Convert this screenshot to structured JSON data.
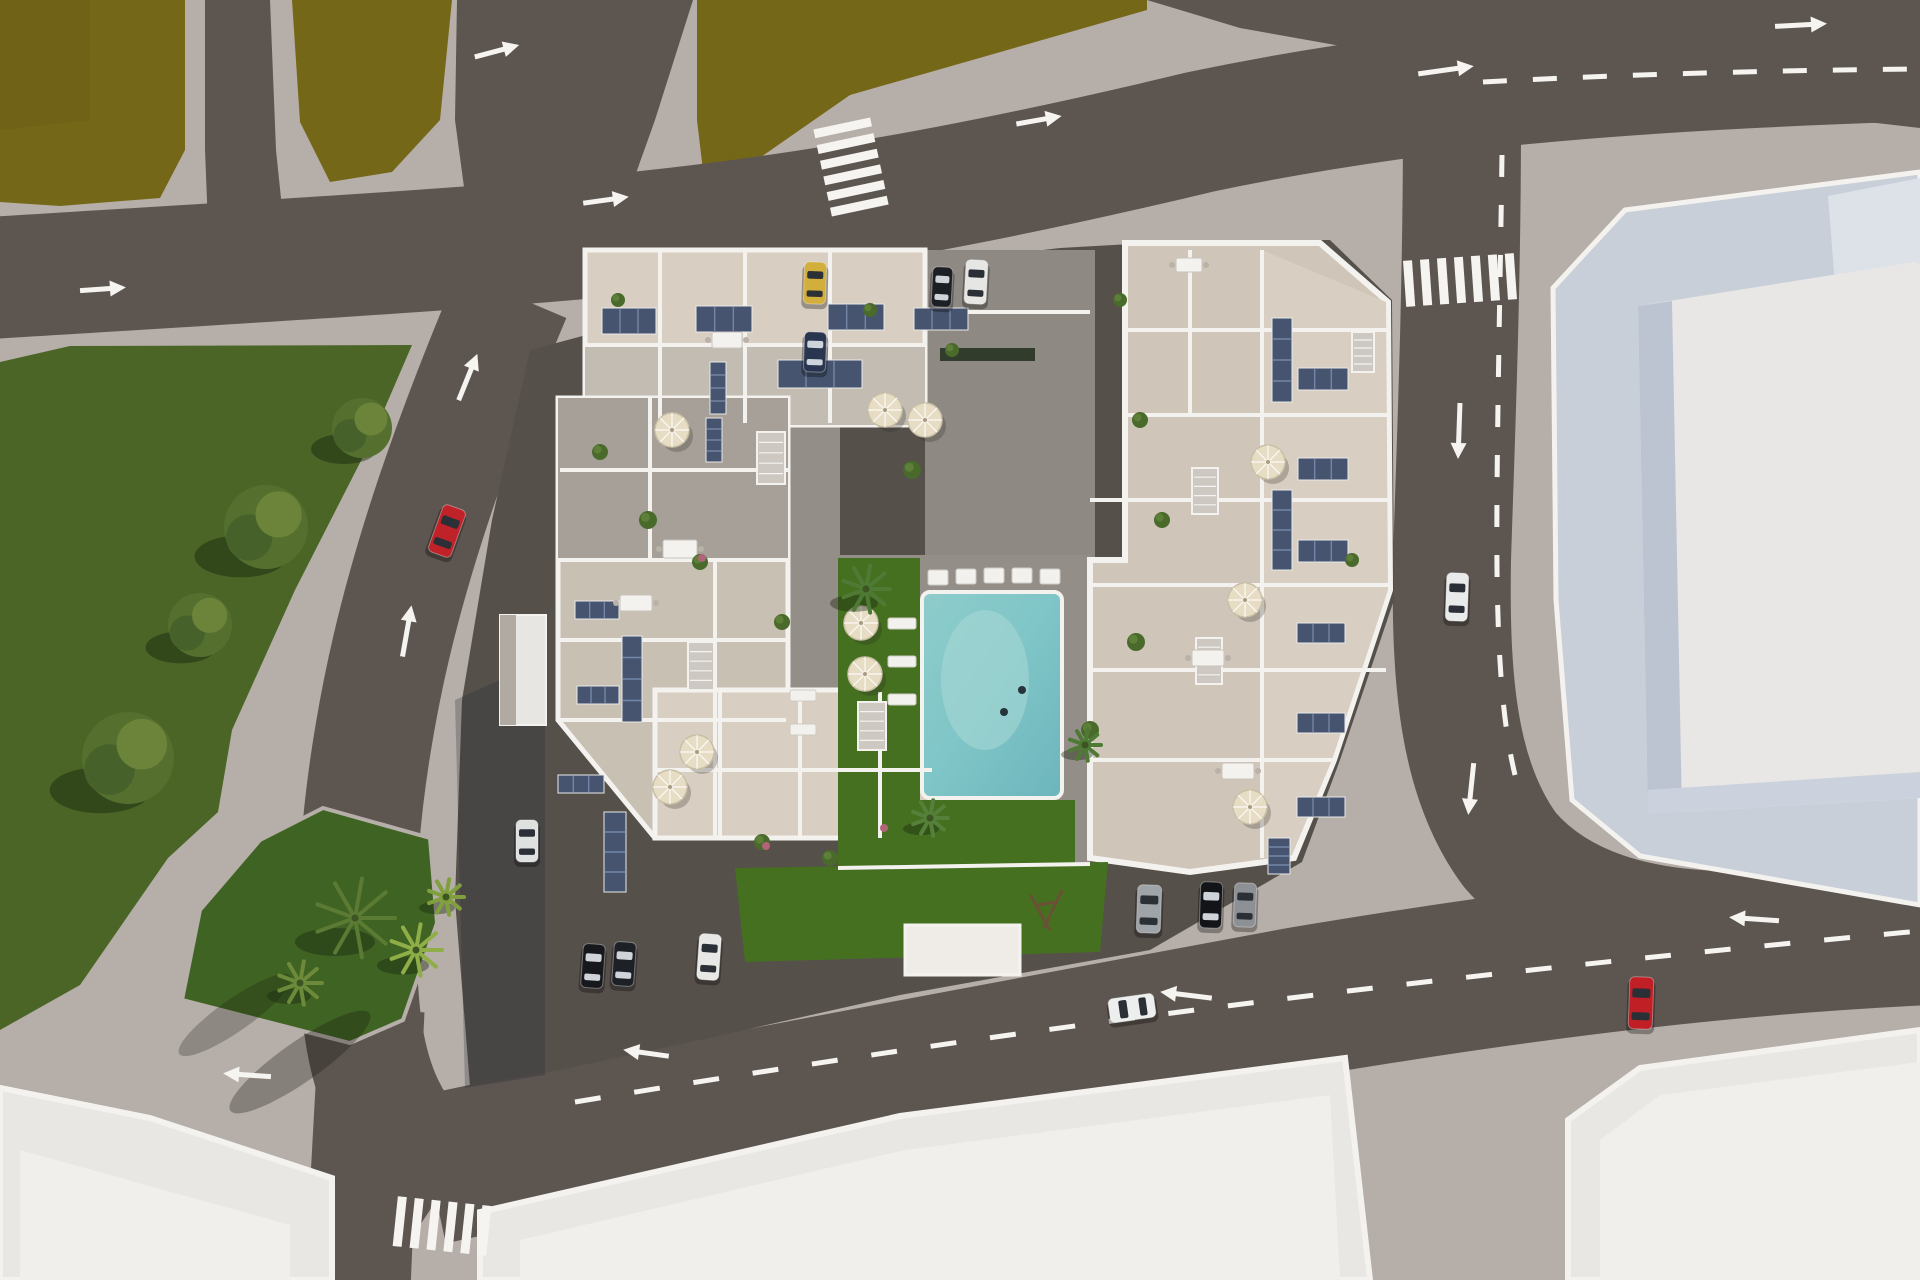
{
  "scene": {
    "description": "aerial-3d-render-residential-complex-with-pool",
    "view": "top-down-site-plan"
  },
  "palette": {
    "sidewalk": "#b6aea8",
    "sidewalkShade": "#9d958f",
    "road": "#5d5550",
    "roadDark": "#544d48",
    "apron": "#56504b",
    "field": "#756718",
    "fieldDark": "#665a14",
    "park": "#4a6526",
    "parkDark": "#36511c",
    "lawn": "#447020",
    "island": "#3f6322",
    "pool": "#7fc5c7",
    "poolLight": "#a9d9d6",
    "white": "#f4f2ef",
    "beige": "#d8cec1",
    "beigeShade": "#c3bcb2",
    "roofGray": "#a6a099",
    "roofGray2": "#c9c0b4",
    "eastWest": "#cfc5b8",
    "courtPave": "#948e88",
    "entryPave": "#8f8983",
    "panel": "#46546f",
    "panelLine": "#7487a8",
    "umbrella": "#e7ddc5",
    "stair": "#cdc8c1",
    "bigBuildTop": "#e9e7e6",
    "bigBuildSide": "#bdc4d1",
    "bigBuildPlinth": "#c9cfd9",
    "bigBuildWing": "#dde1e8",
    "bottomBuild": "#e9e7e4",
    "bottomBuildIn": "#f1efec",
    "marking": "#f5f4f1"
  },
  "cars": [
    {
      "name": "car-red-left-road",
      "x": 447,
      "y": 531,
      "w": 24,
      "h": 50,
      "rot": 20,
      "color": "#bf2228",
      "dark": false
    },
    {
      "name": "car-yellow-parked-top",
      "x": 815,
      "y": 283,
      "w": 22,
      "h": 42,
      "rot": 2,
      "color": "#d2ae3c",
      "dark": false
    },
    {
      "name": "car-darkblue-parked-top",
      "x": 815,
      "y": 352,
      "w": 22,
      "h": 40,
      "rot": 2,
      "color": "#2a3550",
      "dark": true
    },
    {
      "name": "car-black-parked-top",
      "x": 942,
      "y": 287,
      "w": 20,
      "h": 40,
      "rot": 3,
      "color": "#1c1f24",
      "dark": true
    },
    {
      "name": "car-white-parked-top",
      "x": 976,
      "y": 282,
      "w": 22,
      "h": 44,
      "rot": 3,
      "color": "#e6e6e4",
      "dark": false
    },
    {
      "name": "car-white-parked-west",
      "x": 527,
      "y": 841,
      "w": 22,
      "h": 42,
      "rot": 0,
      "color": "#dfe0e0",
      "dark": false
    },
    {
      "name": "car-dark-parked-south-1",
      "x": 593,
      "y": 966,
      "w": 22,
      "h": 44,
      "rot": 4,
      "color": "#16181c",
      "dark": true
    },
    {
      "name": "car-dark-parked-south-2",
      "x": 624,
      "y": 964,
      "w": 22,
      "h": 44,
      "rot": 4,
      "color": "#1d2026",
      "dark": true
    },
    {
      "name": "car-white-parked-south",
      "x": 709,
      "y": 957,
      "w": 22,
      "h": 46,
      "rot": 4,
      "color": "#e8e8e6",
      "dark": false
    },
    {
      "name": "car-silver-parked-southeast",
      "x": 1149,
      "y": 909,
      "w": 24,
      "h": 48,
      "rot": 2,
      "color": "#9fa4a8",
      "dark": false
    },
    {
      "name": "car-black-parked-southeast",
      "x": 1211,
      "y": 905,
      "w": 22,
      "h": 46,
      "rot": 2,
      "color": "#121418",
      "dark": true
    },
    {
      "name": "car-gray-parked-southeast",
      "x": 1245,
      "y": 905,
      "w": 22,
      "h": 44,
      "rot": 2,
      "color": "#8d9196",
      "dark": false
    },
    {
      "name": "car-white-driving-bottom-road",
      "x": 1132,
      "y": 1008,
      "w": 46,
      "h": 24,
      "rot": -8,
      "color": "#edeeee",
      "dark": false
    },
    {
      "name": "car-red-bottom-right",
      "x": 1641,
      "y": 1003,
      "w": 24,
      "h": 52,
      "rot": 2,
      "color": "#c01f26",
      "dark": false
    },
    {
      "name": "car-white-right-road",
      "x": 1457,
      "y": 597,
      "w": 22,
      "h": 48,
      "rot": 2,
      "color": "#e9eaea",
      "dark": false
    }
  ],
  "arrows": [
    {
      "name": "arrow-top-vertical-road",
      "x": 497,
      "y": 51,
      "rot": -15,
      "len": 46
    },
    {
      "name": "arrow-left-road",
      "x": 103,
      "y": 289,
      "rot": -4,
      "len": 46
    },
    {
      "name": "arrow-mid-top-road",
      "x": 606,
      "y": 200,
      "rot": -8,
      "len": 46
    },
    {
      "name": "arrow-diag-road-up-1",
      "x": 468,
      "y": 377,
      "rot": -68,
      "len": 50
    },
    {
      "name": "arrow-diag-road-up-2",
      "x": 407,
      "y": 631,
      "rot": -80,
      "len": 52
    },
    {
      "name": "arrow-top-road-east",
      "x": 1039,
      "y": 120,
      "rot": -10,
      "len": 46
    },
    {
      "name": "arrow-top-right",
      "x": 1801,
      "y": 25,
      "rot": -3,
      "len": 52
    },
    {
      "name": "arrow-merge-top-right",
      "x": 1446,
      "y": 70,
      "rot": -8,
      "len": 56
    },
    {
      "name": "arrow-right-road-down-1",
      "x": 1459,
      "y": 431,
      "rot": 92,
      "len": 56
    },
    {
      "name": "arrow-right-road-down-2",
      "x": 1471,
      "y": 789,
      "rot": 96,
      "len": 52
    },
    {
      "name": "arrow-bottom-road-left-1",
      "x": 1186,
      "y": 995,
      "rot": 187,
      "len": 52
    },
    {
      "name": "arrow-bottom-road-left-2",
      "x": 646,
      "y": 1053,
      "rot": 188,
      "len": 46
    },
    {
      "name": "arrow-bottom-road-left-3",
      "x": 247,
      "y": 1075,
      "rot": 184,
      "len": 48
    },
    {
      "name": "arrow-bottom-right-road",
      "x": 1754,
      "y": 919,
      "rot": 184,
      "len": 50
    }
  ],
  "crosswalks": [
    {
      "name": "crosswalk-top-middle",
      "x": 851,
      "y": 167,
      "rot": -12,
      "count": 6,
      "sw": 58,
      "sh": 9,
      "gap": 7,
      "dir": "h"
    },
    {
      "name": "crosswalk-right-road",
      "x": 1460,
      "y": 280,
      "rot": -4,
      "count": 7,
      "sw": 9,
      "sh": 46,
      "gap": 8,
      "dir": "v"
    },
    {
      "name": "crosswalk-bottom-left",
      "x": 442,
      "y": 1226,
      "rot": 6,
      "count": 6,
      "sw": 9,
      "sh": 50,
      "gap": 8,
      "dir": "v"
    }
  ],
  "dashes": [
    {
      "name": "lane-dash-bottom-road",
      "path": "M575,1102 C900,1048 1300,988 1920,931",
      "dash": "26 34"
    },
    {
      "name": "lane-dash-right-road",
      "path": "M1502,155 C1500,300 1496,470 1497,570 C1498,660 1503,725 1515,775",
      "dash": "22 28"
    },
    {
      "name": "lane-dash-top-right-road",
      "path": "M1483,82 C1630,74 1790,70 1920,69",
      "dash": "24 26"
    }
  ],
  "trees": [
    {
      "name": "park-tree-1",
      "x": 362,
      "y": 428,
      "r": 30
    },
    {
      "name": "park-tree-2",
      "x": 266,
      "y": 527,
      "r": 42
    },
    {
      "name": "park-tree-3",
      "x": 200,
      "y": 625,
      "r": 32
    },
    {
      "name": "park-tree-4",
      "x": 128,
      "y": 758,
      "r": 46
    }
  ],
  "palms": [
    {
      "name": "palm-island-large",
      "x": 355,
      "y": 918,
      "r": 40,
      "color": "#5b7a33"
    },
    {
      "name": "palm-island-bright",
      "x": 416,
      "y": 950,
      "r": 26,
      "color": "#8fae47"
    },
    {
      "name": "palm-island-small",
      "x": 300,
      "y": 983,
      "r": 22,
      "color": "#6d8a3a"
    },
    {
      "name": "palm-island-bush",
      "x": 446,
      "y": 897,
      "r": 18,
      "color": "#7fa03c"
    },
    {
      "name": "palm-courtyard",
      "x": 866,
      "y": 589,
      "r": 24,
      "color": "#4f7a35"
    },
    {
      "name": "palm-courtyard-south",
      "x": 930,
      "y": 818,
      "r": 18,
      "color": "#55803a"
    },
    {
      "name": "palm-pool-corner",
      "x": 1085,
      "y": 745,
      "r": 16,
      "color": "#4f7a35"
    }
  ],
  "plants": [
    {
      "x": 600,
      "y": 452,
      "r": 8
    },
    {
      "x": 648,
      "y": 520,
      "r": 9
    },
    {
      "x": 700,
      "y": 562,
      "r": 8
    },
    {
      "x": 782,
      "y": 622,
      "r": 8
    },
    {
      "x": 912,
      "y": 470,
      "r": 9
    },
    {
      "x": 1140,
      "y": 420,
      "r": 8
    },
    {
      "x": 1162,
      "y": 520,
      "r": 8
    },
    {
      "x": 1136,
      "y": 642,
      "r": 9
    },
    {
      "x": 762,
      "y": 842,
      "r": 8
    },
    {
      "x": 830,
      "y": 858,
      "r": 8
    },
    {
      "x": 1090,
      "y": 730,
      "r": 9
    },
    {
      "x": 952,
      "y": 350,
      "r": 7
    },
    {
      "x": 618,
      "y": 300,
      "r": 7
    },
    {
      "x": 870,
      "y": 310,
      "r": 7
    },
    {
      "x": 1352,
      "y": 560,
      "r": 7
    },
    {
      "x": 1120,
      "y": 300,
      "r": 7
    }
  ],
  "flowers": [
    {
      "x": 702,
      "y": 558,
      "r": 4
    },
    {
      "x": 884,
      "y": 828,
      "r": 4
    },
    {
      "x": 766,
      "y": 846,
      "r": 4
    }
  ],
  "umbrellas": [
    {
      "x": 672,
      "y": 430
    },
    {
      "x": 885,
      "y": 410
    },
    {
      "x": 925,
      "y": 420
    },
    {
      "x": 861,
      "y": 623
    },
    {
      "x": 865,
      "y": 674
    },
    {
      "x": 697,
      "y": 752
    },
    {
      "x": 670,
      "y": 787
    },
    {
      "x": 1268,
      "y": 462
    },
    {
      "x": 1245,
      "y": 600
    },
    {
      "x": 1250,
      "y": 807
    }
  ],
  "panels": [
    {
      "x": 602,
      "y": 308,
      "w": 54,
      "h": 26
    },
    {
      "x": 696,
      "y": 306,
      "w": 56,
      "h": 26
    },
    {
      "x": 828,
      "y": 304,
      "w": 56,
      "h": 26
    },
    {
      "x": 914,
      "y": 308,
      "w": 54,
      "h": 22
    },
    {
      "x": 778,
      "y": 360,
      "w": 84,
      "h": 28
    },
    {
      "x": 710,
      "y": 362,
      "w": 16,
      "h": 52
    },
    {
      "x": 706,
      "y": 418,
      "w": 16,
      "h": 44
    },
    {
      "x": 622,
      "y": 636,
      "w": 20,
      "h": 86
    },
    {
      "x": 575,
      "y": 601,
      "w": 44,
      "h": 18
    },
    {
      "x": 577,
      "y": 686,
      "w": 42,
      "h": 18
    },
    {
      "x": 558,
      "y": 775,
      "w": 46,
      "h": 18
    },
    {
      "x": 604,
      "y": 812,
      "w": 22,
      "h": 80
    },
    {
      "x": 1272,
      "y": 318,
      "w": 20,
      "h": 84
    },
    {
      "x": 1272,
      "y": 490,
      "w": 20,
      "h": 80
    },
    {
      "x": 1298,
      "y": 368,
      "w": 50,
      "h": 22
    },
    {
      "x": 1298,
      "y": 458,
      "w": 50,
      "h": 22
    },
    {
      "x": 1298,
      "y": 540,
      "w": 50,
      "h": 22
    },
    {
      "x": 1297,
      "y": 623,
      "w": 48,
      "h": 20
    },
    {
      "x": 1297,
      "y": 713,
      "w": 48,
      "h": 20
    },
    {
      "x": 1297,
      "y": 797,
      "w": 48,
      "h": 20
    },
    {
      "x": 1268,
      "y": 838,
      "w": 22,
      "h": 36
    }
  ],
  "loungers": [
    {
      "x": 928,
      "y": 570,
      "w": 20,
      "h": 15
    },
    {
      "x": 956,
      "y": 569,
      "w": 20,
      "h": 15
    },
    {
      "x": 984,
      "y": 568,
      "w": 20,
      "h": 15
    },
    {
      "x": 1012,
      "y": 568,
      "w": 20,
      "h": 15
    },
    {
      "x": 1040,
      "y": 569,
      "w": 20,
      "h": 15
    },
    {
      "x": 888,
      "y": 618,
      "w": 28,
      "h": 11
    },
    {
      "x": 888,
      "y": 656,
      "w": 28,
      "h": 11
    },
    {
      "x": 888,
      "y": 694,
      "w": 28,
      "h": 11
    },
    {
      "x": 790,
      "y": 690,
      "w": 26,
      "h": 11
    },
    {
      "x": 790,
      "y": 724,
      "w": 26,
      "h": 11
    }
  ],
  "tables": [
    {
      "x": 663,
      "y": 540,
      "w": 34,
      "h": 18
    },
    {
      "x": 620,
      "y": 595,
      "w": 32,
      "h": 16
    },
    {
      "x": 712,
      "y": 332,
      "w": 30,
      "h": 16
    },
    {
      "x": 1192,
      "y": 650,
      "w": 32,
      "h": 16
    },
    {
      "x": 1222,
      "y": 763,
      "w": 32,
      "h": 16
    },
    {
      "x": 1176,
      "y": 258,
      "w": 26,
      "h": 14
    }
  ],
  "stairs": [
    {
      "x": 757,
      "y": 432,
      "w": 28,
      "h": 52
    },
    {
      "x": 688,
      "y": 642,
      "w": 26,
      "h": 48
    },
    {
      "x": 858,
      "y": 702,
      "w": 28,
      "h": 48
    },
    {
      "x": 1192,
      "y": 468,
      "w": 26,
      "h": 46
    },
    {
      "x": 1196,
      "y": 638,
      "w": 26,
      "h": 46
    },
    {
      "x": 1352,
      "y": 332,
      "w": 22,
      "h": 40
    }
  ]
}
